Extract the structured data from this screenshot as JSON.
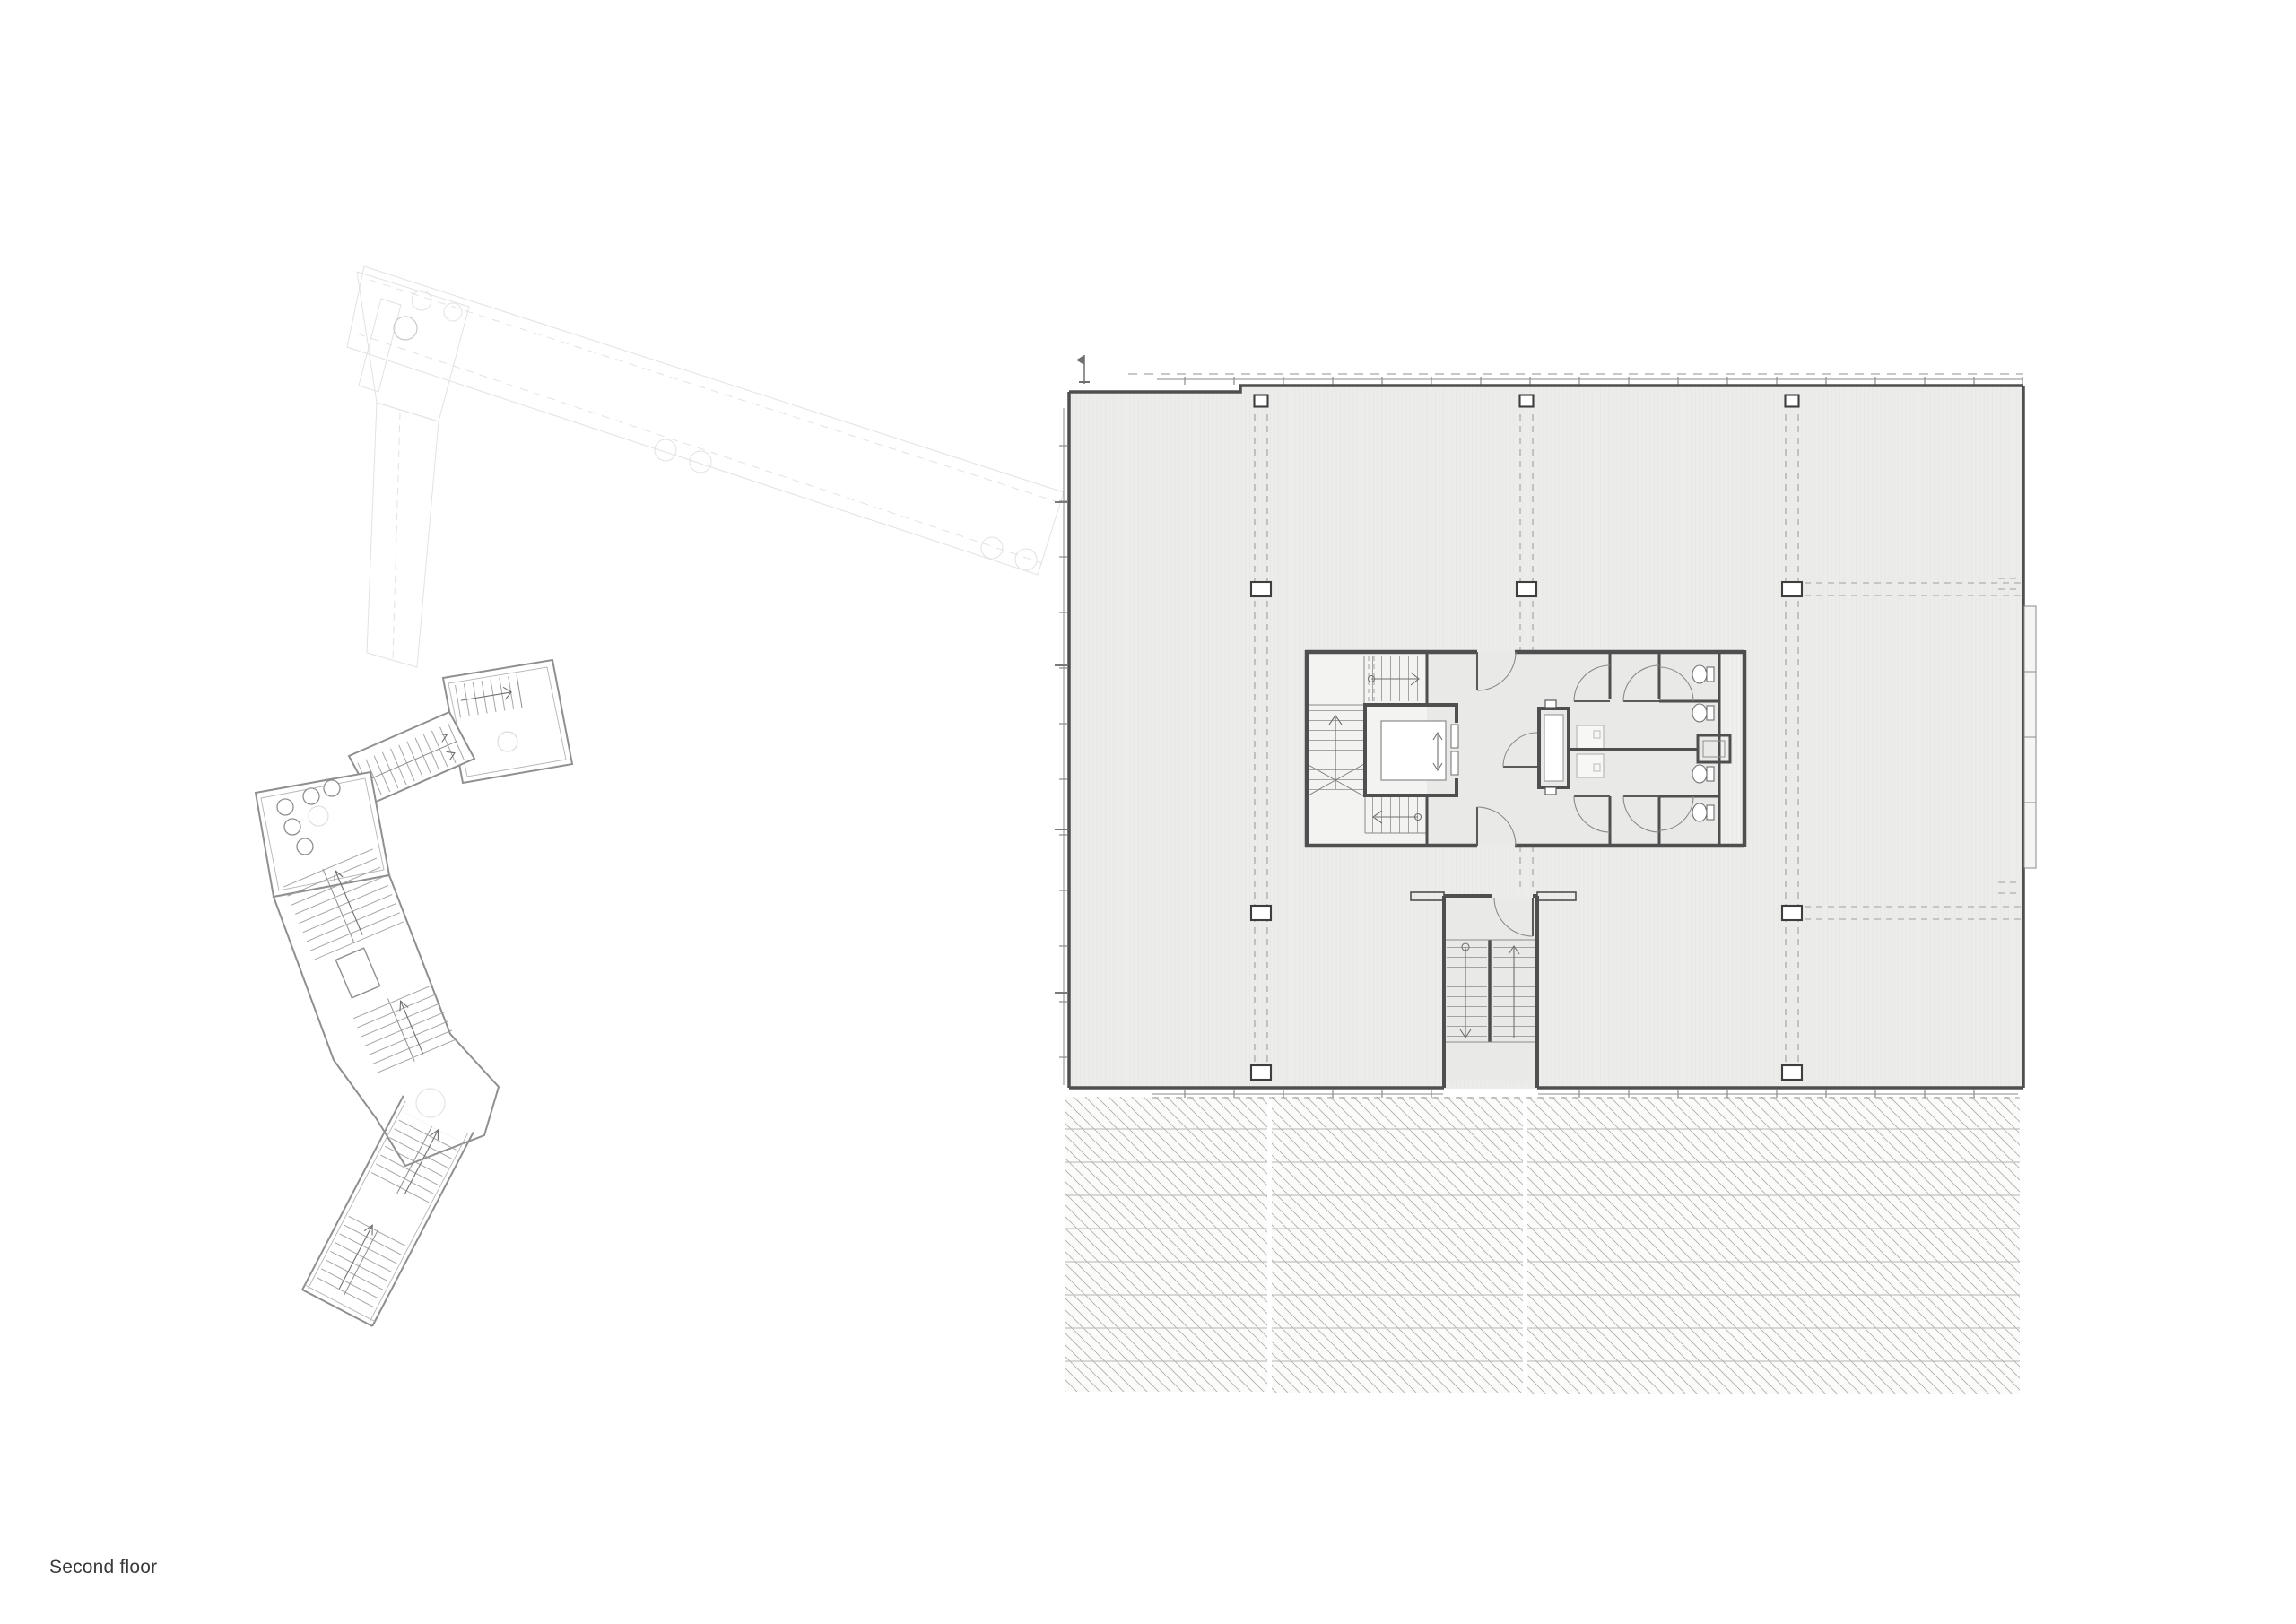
{
  "title": {
    "label": "Second floor"
  },
  "palette": {
    "paper": "#ffffff",
    "floor": "#ecedea",
    "core_room": "#e9eae7",
    "stair_zone": "#f3f3f1",
    "wall": "#4f4f4f",
    "thin_line": "#8a8a8a",
    "grid_line": "#9f9f9f",
    "hatch_line": "#aeaeae",
    "hatch_bg": "#fbfbf9",
    "ghost_line": "#e2e2e2",
    "west_wing_line": "#8f8f8f",
    "label_ink": "#3a3a3a"
  },
  "drawing": {
    "kind": "architectural plan",
    "parts": [
      "ghost adjacent wing",
      "west zigzag annex with stairs and toilets",
      "main floor plate with structural grid",
      "central core: stair, elevator, wc block",
      "south stairwell",
      "hatched existing building below"
    ]
  }
}
